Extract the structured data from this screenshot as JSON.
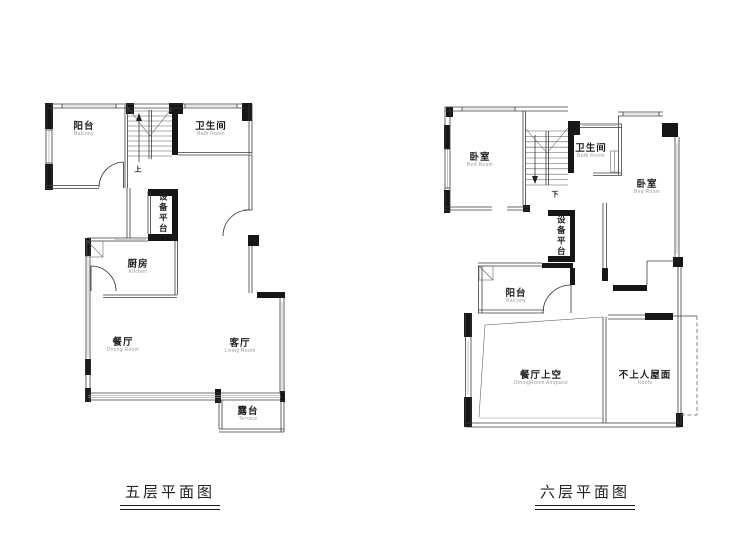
{
  "colors": {
    "background": "#ffffff",
    "wall": "#161616",
    "line": "#3c3c3c",
    "window": "#9a9a9a",
    "label_text": "#1e1e1e",
    "sub_text": "#9a9a9a"
  },
  "plans": {
    "left": {
      "caption": "五层平面图",
      "stair_label": "上",
      "rooms": {
        "balcony": {
          "zh": "阳台",
          "en": "Balcony"
        },
        "bathroom": {
          "zh": "卫生间",
          "en": "Bath Room"
        },
        "equipment": {
          "zh": "设备平台"
        },
        "kitchen": {
          "zh": "厨房",
          "en": "Kitchen"
        },
        "dining": {
          "zh": "餐厅",
          "en": "Dining Room"
        },
        "living": {
          "zh": "客厅",
          "en": "Living Room"
        },
        "terrace": {
          "zh": "露台",
          "en": "Terrace"
        }
      }
    },
    "right": {
      "caption": "六层平面图",
      "stair_label": "下",
      "rooms": {
        "bedroom_left": {
          "zh": "卧室",
          "en": "Bed Room"
        },
        "bathroom": {
          "zh": "卫生间",
          "en": "Bath Room"
        },
        "bedroom_right": {
          "zh": "卧室",
          "en": "Bed Room"
        },
        "equipment": {
          "zh": "设备平台"
        },
        "balcony": {
          "zh": "阳台",
          "en": "Balcony"
        },
        "dining_void": {
          "zh": "餐厅上空",
          "en": "DiningRoom Airspace"
        },
        "roof": {
          "zh": "不上人屋面",
          "en": "Roofs"
        }
      }
    }
  }
}
